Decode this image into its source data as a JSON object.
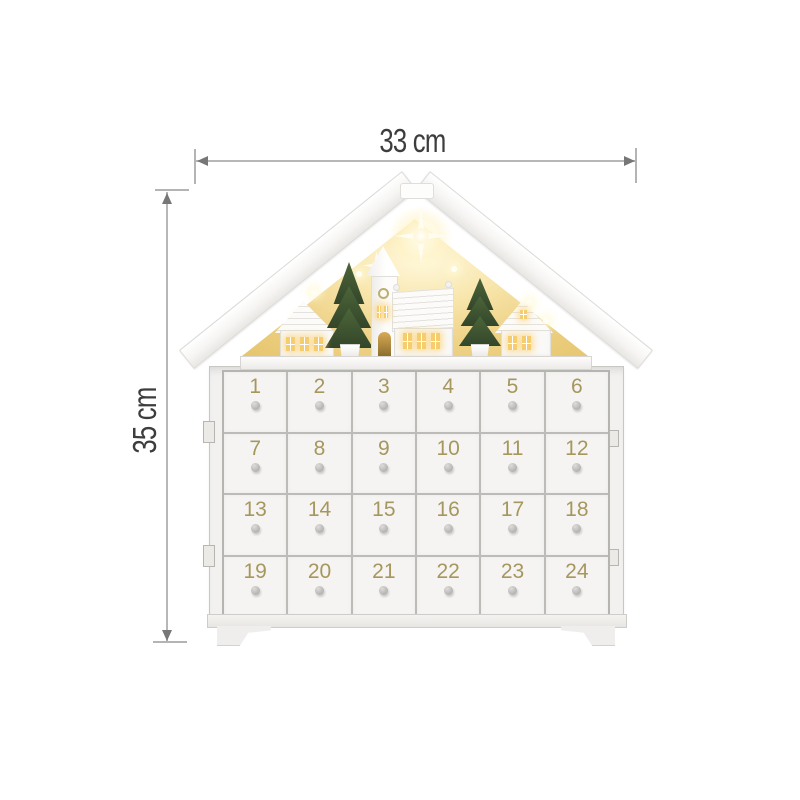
{
  "annotations": {
    "width_label": "33 cm",
    "height_label": "35 cm"
  },
  "calendar": {
    "type": "wooden advent calendar house",
    "rows": 4,
    "columns": 6,
    "drawer_numbers": [
      "1",
      "2",
      "3",
      "4",
      "5",
      "6",
      "7",
      "8",
      "9",
      "10",
      "11",
      "12",
      "13",
      "14",
      "15",
      "16",
      "17",
      "18",
      "19",
      "20",
      "21",
      "22",
      "23",
      "24"
    ]
  },
  "scene": {
    "elements": [
      "star-light-icon",
      "led-light-icon",
      "christmas-tree-icon",
      "church-icon",
      "cottage-icon"
    ]
  },
  "colors": {
    "background": "#ffffff",
    "dimension_line": "#b7b7b7",
    "dimension_text": "#3d3d3d",
    "number_gold": "#a5975d",
    "glow_amber": "#eed287",
    "window_amber": "#f5cd6f",
    "tree_green": "#3f5530",
    "drawer_face": "#f5f4f2",
    "drawer_border": "#bdbbb7",
    "knob_gray": "#a3a19e"
  }
}
